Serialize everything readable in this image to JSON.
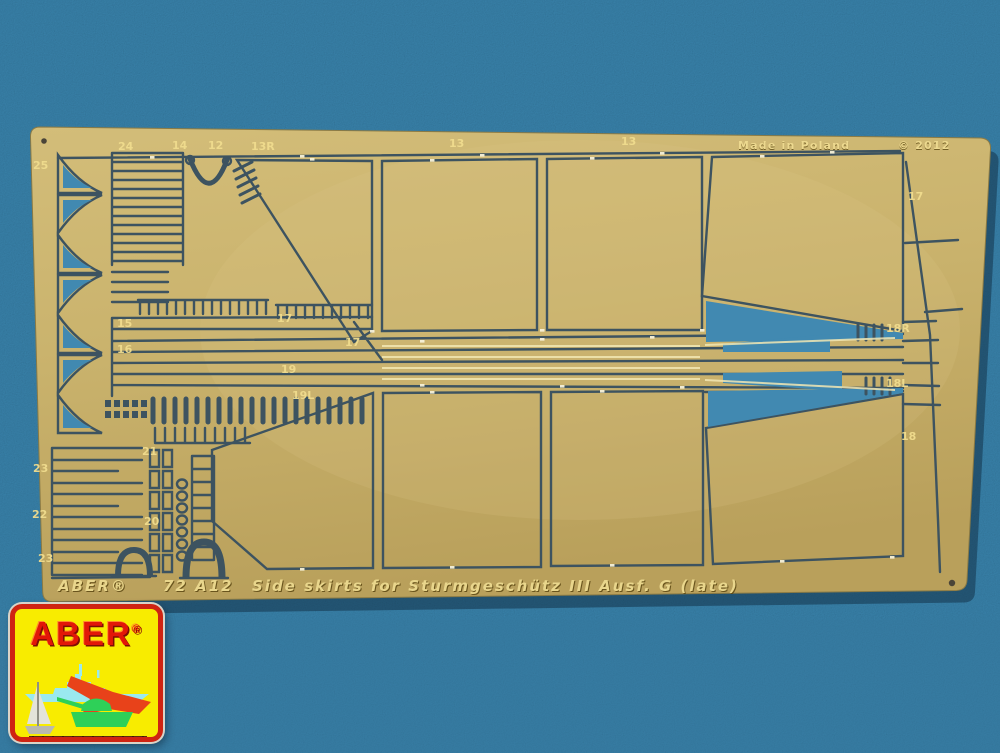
{
  "scene": {
    "background_color": "#3e8ab4",
    "plate_color": "#c9b26c",
    "etch_color": "#3d5360",
    "cutout_color": "#4189b1",
    "label_color": "#f0dc8e"
  },
  "plate": {
    "legend": {
      "brand": "ABER®",
      "code": "72 A12",
      "description": "Side skirts for Sturmgeschütz III Ausf. G (late)"
    },
    "top_right": {
      "origin": "Made in Poland",
      "copyright": "© 2012"
    },
    "part_labels": [
      {
        "text": "25",
        "x": 33,
        "y": 169
      },
      {
        "text": "24",
        "x": 118,
        "y": 150
      },
      {
        "text": "14",
        "x": 172,
        "y": 149
      },
      {
        "text": "12",
        "x": 208,
        "y": 149
      },
      {
        "text": "13R",
        "x": 251,
        "y": 150
      },
      {
        "text": "13",
        "x": 449,
        "y": 147
      },
      {
        "text": "13",
        "x": 621,
        "y": 145
      },
      {
        "text": "17",
        "x": 908,
        "y": 200
      },
      {
        "text": "15",
        "x": 117,
        "y": 327
      },
      {
        "text": "16",
        "x": 117,
        "y": 353
      },
      {
        "text": "17",
        "x": 277,
        "y": 322
      },
      {
        "text": "17",
        "x": 345,
        "y": 346
      },
      {
        "text": "19",
        "x": 281,
        "y": 373
      },
      {
        "text": "19L",
        "x": 292,
        "y": 399
      },
      {
        "text": "18R",
        "x": 886,
        "y": 332
      },
      {
        "text": "18L",
        "x": 886,
        "y": 387
      },
      {
        "text": "18",
        "x": 901,
        "y": 440
      },
      {
        "text": "23",
        "x": 33,
        "y": 472
      },
      {
        "text": "22",
        "x": 32,
        "y": 518
      },
      {
        "text": "23",
        "x": 38,
        "y": 562
      },
      {
        "text": "21",
        "x": 142,
        "y": 455
      },
      {
        "text": "20",
        "x": 144,
        "y": 525
      }
    ]
  },
  "logo": {
    "brand": "ABER",
    "registered": "®"
  }
}
